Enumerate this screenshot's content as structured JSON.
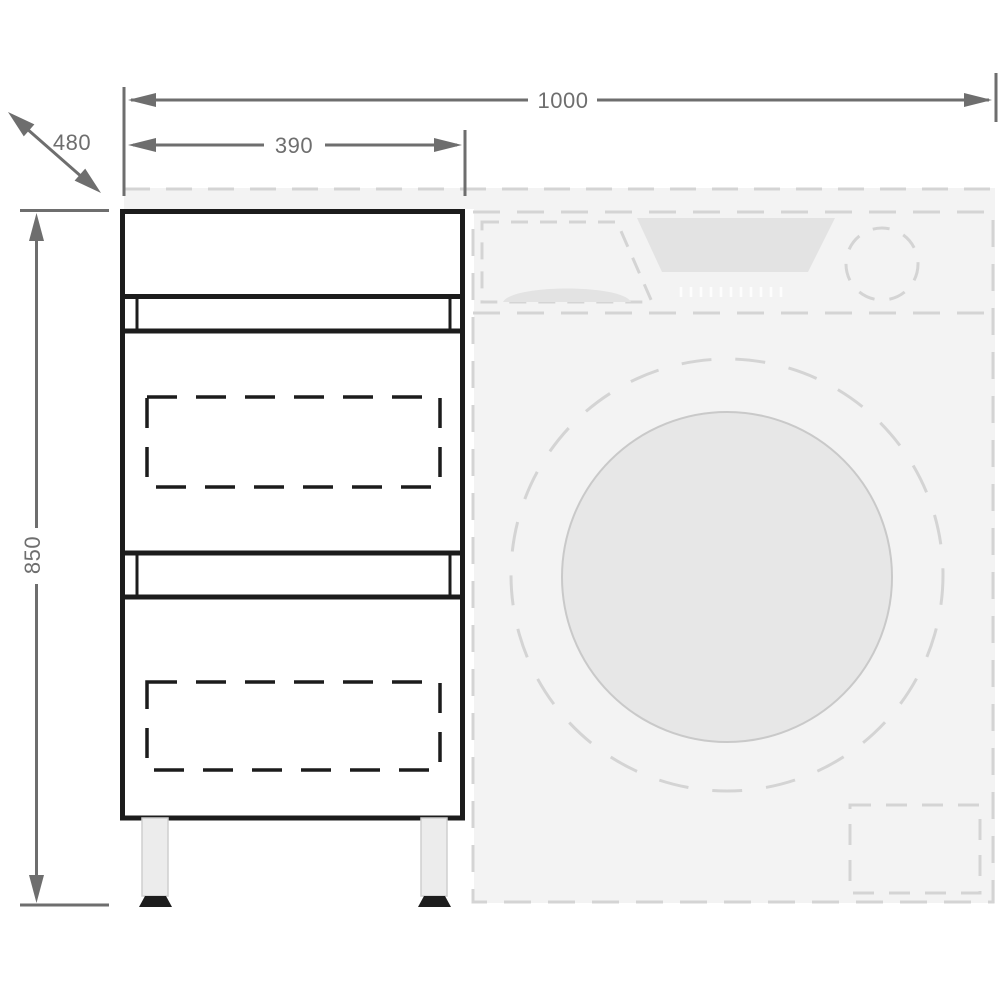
{
  "dimensions": {
    "total_width": "1000",
    "cabinet_width": "390",
    "depth": "480",
    "height": "850"
  },
  "colors": {
    "dim": "#6e6e6e",
    "cabinet": "#1c1c1c",
    "ghost-stroke": "#d4d4d4",
    "ghost-fill": "#f3f3f3",
    "ghost-panel": "#e3e3e3",
    "ghost-glass": "#e7e7e7",
    "glass-stroke": "#c9c9c9",
    "leg-fill": "#ececec",
    "leg-stroke": "#cfcfcf",
    "foot": "#1d1d1d",
    "tick": "#ffffff",
    "background": "#ffffff"
  }
}
